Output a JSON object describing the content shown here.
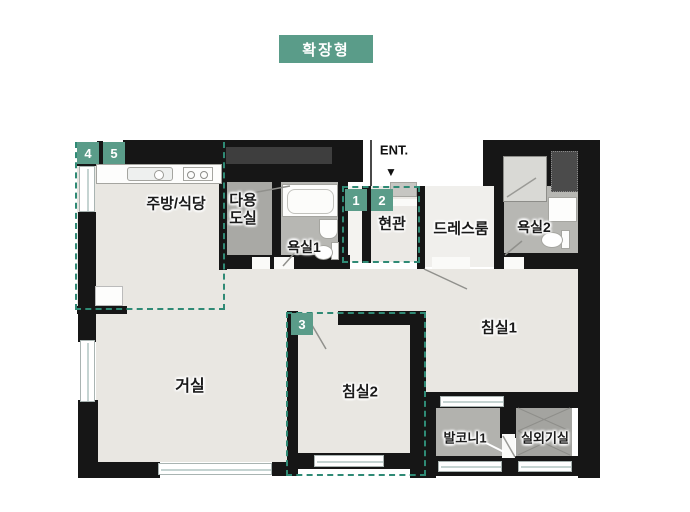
{
  "title": {
    "label": "확장형"
  },
  "entrance": {
    "label": "ENT.",
    "arrow": "▼"
  },
  "rooms": {
    "kitchen": "주방/식당",
    "utility_line1": "다용",
    "utility_line2": "도실",
    "bath1": "욕실1",
    "entry": "현관",
    "dressroom": "드레스룸",
    "bath2": "욕실2",
    "bedroom1": "침실1",
    "living": "거실",
    "bedroom2": "침실2",
    "balcony1": "발코니1",
    "outdoor_unit": "실외기실"
  },
  "badges": {
    "n1": "1",
    "n2": "2",
    "n3": "3",
    "n4": "4",
    "n5": "5"
  },
  "colors": {
    "accent_teal": "#5a9c89",
    "dash_teal": "#2f8a75",
    "wall_black": "#161616",
    "floor_light": "#e9e7e2",
    "floor_gray": "#b7b7b3"
  }
}
